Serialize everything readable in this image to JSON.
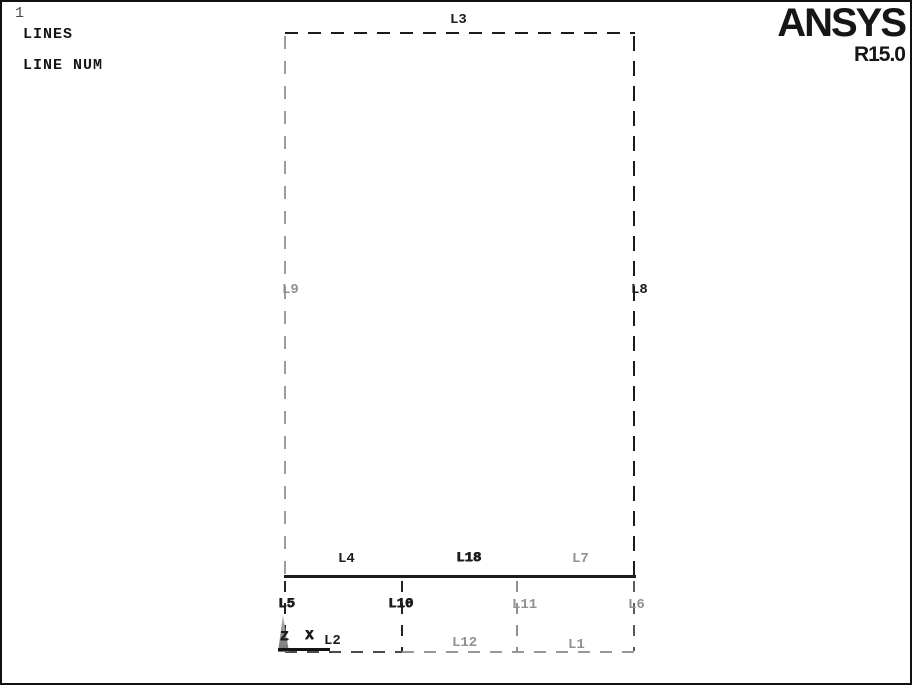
{
  "window": {
    "plot_id": "1",
    "annotation_title": "LINES",
    "annotation_subtitle": "LINE NUM"
  },
  "logo": {
    "brand": "ANSYS",
    "version": "R15.0"
  },
  "triad": {
    "z": "Z",
    "x": "X"
  },
  "labels": {
    "l3": "L3",
    "l9": "L9",
    "l8": "L8",
    "l4": "L4",
    "l18": "L18",
    "l7": "L7",
    "l5": "L5",
    "l10": "L10",
    "l11": "L11",
    "l6": "L6",
    "l2": "L2",
    "l12": "L12",
    "l1": "L1"
  },
  "colors": {
    "line_dark": "#1c1c1c",
    "line_gray": "#999999",
    "background": "#ffffff"
  }
}
